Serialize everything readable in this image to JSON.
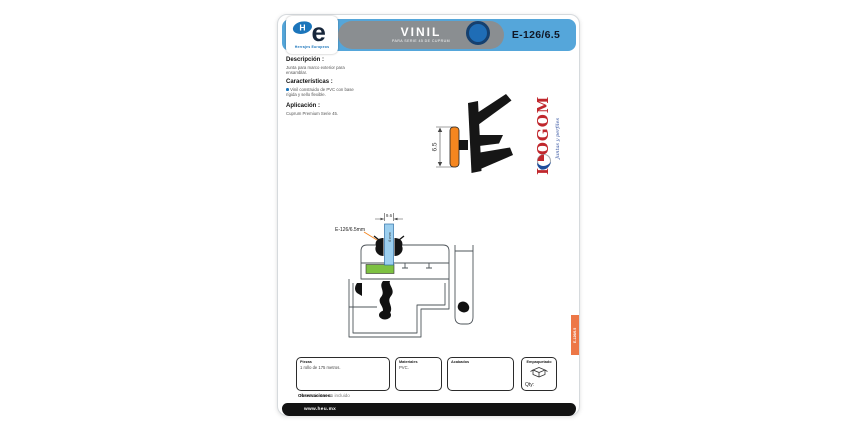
{
  "header": {
    "title": "VINIL",
    "subtitle": "PARA SERIE 45 DE CUPRUM",
    "code": "E-126/6.5",
    "logo": {
      "h": "H",
      "e": "e",
      "caption": "Herrajes Europeos"
    }
  },
  "sections": {
    "descripcion": {
      "heading": "Descripción :",
      "body": "Junta para marco exterior para ensamblar."
    },
    "caracteristicas": {
      "heading": "Características :",
      "body": "Vinil construido de PVC con base rígida y sello flexible."
    },
    "aplicacion": {
      "heading": "Aplicación :",
      "body": "Cuprum Premium Serie 45."
    }
  },
  "profile": {
    "dim": "6.5"
  },
  "isogom": {
    "name": "ISOGOM",
    "tagline": "Juntas y perfiles"
  },
  "drawing": {
    "dim": "9.6",
    "glass": "6 mm",
    "label": "E-126/6.5mm"
  },
  "spec_boxes": [
    {
      "label": "Piezas",
      "value": "1 rollo de 175 metros."
    },
    {
      "label": "Materiales",
      "value": "PVC."
    },
    {
      "label": "Acabados",
      "value": ""
    },
    {
      "label": "Empaquetado",
      "qty": "Qty:"
    }
  ],
  "observaciones": {
    "label": "Observaciones:",
    "text": "Herramientas no incluido"
  },
  "footer": {
    "url": "www.heu.mx"
  },
  "side_tab": {
    "text": "E-126/6.5"
  },
  "colors": {
    "accent_blue": "#55a6da",
    "brand_blue": "#1b75bb",
    "gray_band": "#8a8e91",
    "circle_blue": "#1f6db6",
    "orange": "#f5861f",
    "tab_orange": "#ed7747",
    "isogom_red": "#c0272d",
    "script_blue": "#2e4e9e",
    "glass_blue": "#9ccfef",
    "block_green": "#7dc142"
  }
}
